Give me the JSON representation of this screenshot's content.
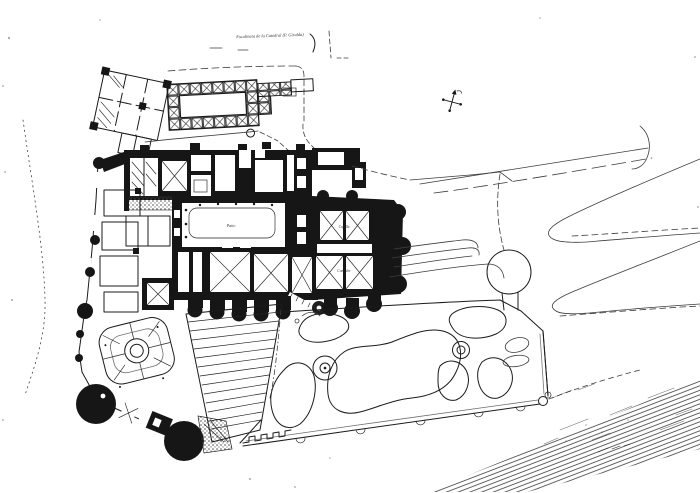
{
  "figure": {
    "kind": "scanned architectural site plan",
    "compass_icon": "compass-cross"
  },
  "colors": {
    "ink": "#1b1b1b",
    "paper": "#ffffff",
    "faint_ink": "#3c3c3c"
  },
  "annotations": {
    "street_label": "Escalinata de la Catedral (P. Giralda)",
    "courtyard_label": "Patio",
    "east_room_upper_label": "Capilla",
    "east_room_lower_label": "Comedor"
  }
}
